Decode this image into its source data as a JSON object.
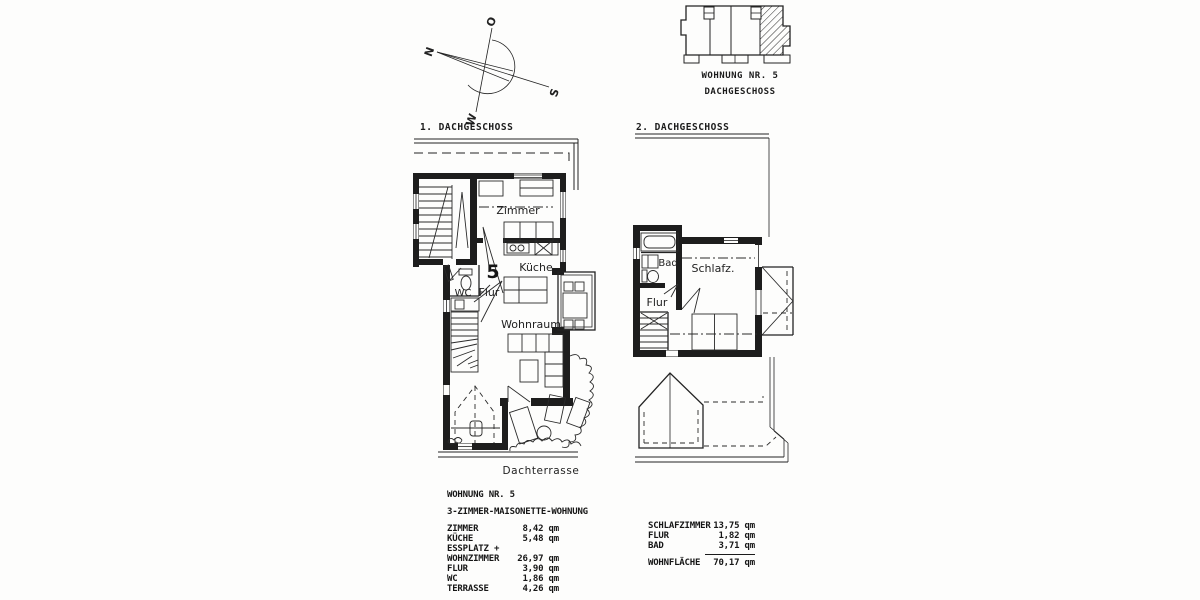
{
  "compass": {
    "north": "N",
    "east": "O",
    "south": "S",
    "west": "W"
  },
  "key_plan": {
    "title": "WOHNUNG NR. 5",
    "subtitle": "DACHGESCHOSS"
  },
  "plan1": {
    "title": "1. DACHGESCHOSS",
    "unit_number": "5",
    "rooms": {
      "zimmer": "Zimmer",
      "kueche": "Küche",
      "wc": "WC",
      "flur": "Flur",
      "wohnraum": "Wohnraum"
    },
    "terrace_label": "Dachterrasse"
  },
  "plan2": {
    "title": "2. DACHGESCHOSS",
    "rooms": {
      "bad": "Bad",
      "schlafzimmer": "Schlafz.",
      "flur": "Flur"
    }
  },
  "area_table_1": {
    "title": "WOHNUNG NR. 5",
    "subtitle": "3-ZIMMER-MAISONETTE-WOHNUNG",
    "rows": [
      {
        "label": "ZIMMER",
        "value": "8,42 qm"
      },
      {
        "label": "KÜCHE",
        "value": "5,48 qm"
      },
      {
        "label": "ESSPLATZ +",
        "value": ""
      },
      {
        "label": "WOHNZIMMER",
        "value": "26,97 qm"
      },
      {
        "label": "FLUR",
        "value": "3,90 qm"
      },
      {
        "label": "WC",
        "value": "1,86 qm"
      },
      {
        "label": "TERRASSE",
        "value": "4,26 qm"
      }
    ]
  },
  "area_table_2": {
    "rows": [
      {
        "label": "SCHLAFZIMMER",
        "value": "13,75 qm"
      },
      {
        "label": "FLUR",
        "value": "1,82 qm"
      },
      {
        "label": "BAD",
        "value": "3,71 qm"
      }
    ],
    "total": {
      "label": "WOHNFLÄCHE",
      "value": "70,17 qm"
    }
  }
}
